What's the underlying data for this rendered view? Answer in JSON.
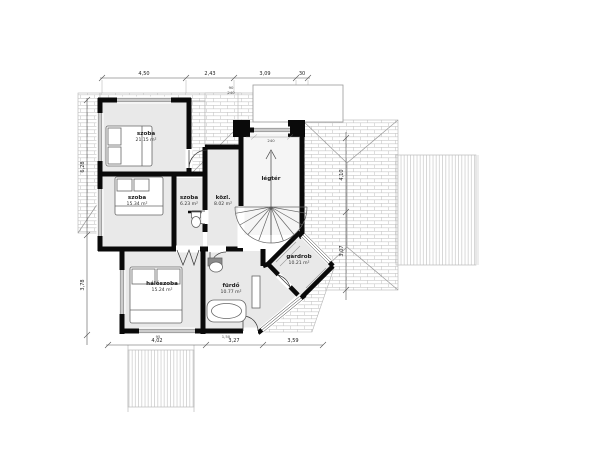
{
  "drawing": {
    "type": "architectural-floor-plan",
    "floor": "emelet"
  },
  "colors": {
    "wall": "#0a0a0a",
    "room_fill": "#e9e9e9",
    "stair_fill": "#f5f5f5",
    "roof_hatch": "#c8c8c8",
    "deck_stripe": "#c9c9c9",
    "dim_line": "#555555",
    "text": "#1a1a1a"
  },
  "rooms": [
    {
      "name": "szoba",
      "area": "21.15 m²"
    },
    {
      "name": "szoba",
      "area": "15.34 m²"
    },
    {
      "name": "szoba",
      "area": "6.23 m²"
    },
    {
      "name": "közl.",
      "area": "8.02 m²"
    },
    {
      "name": "légtér",
      "area": ""
    },
    {
      "name": "hálószoba",
      "area": "15.24 m²"
    },
    {
      "name": "fürdő",
      "area": "10.77 m²"
    },
    {
      "name": "gardrob",
      "area": "10.21 m²"
    }
  ],
  "dims": {
    "top": [
      "4,50",
      "2,43",
      "3,09",
      "30"
    ],
    "bottom": [
      "4,02",
      "3,27",
      "3,59"
    ],
    "left": [
      "6,28",
      "3,78"
    ],
    "right": [
      "4,10",
      "3,07"
    ],
    "marks": [
      "90",
      "240",
      "240",
      "95",
      "1,50"
    ]
  }
}
